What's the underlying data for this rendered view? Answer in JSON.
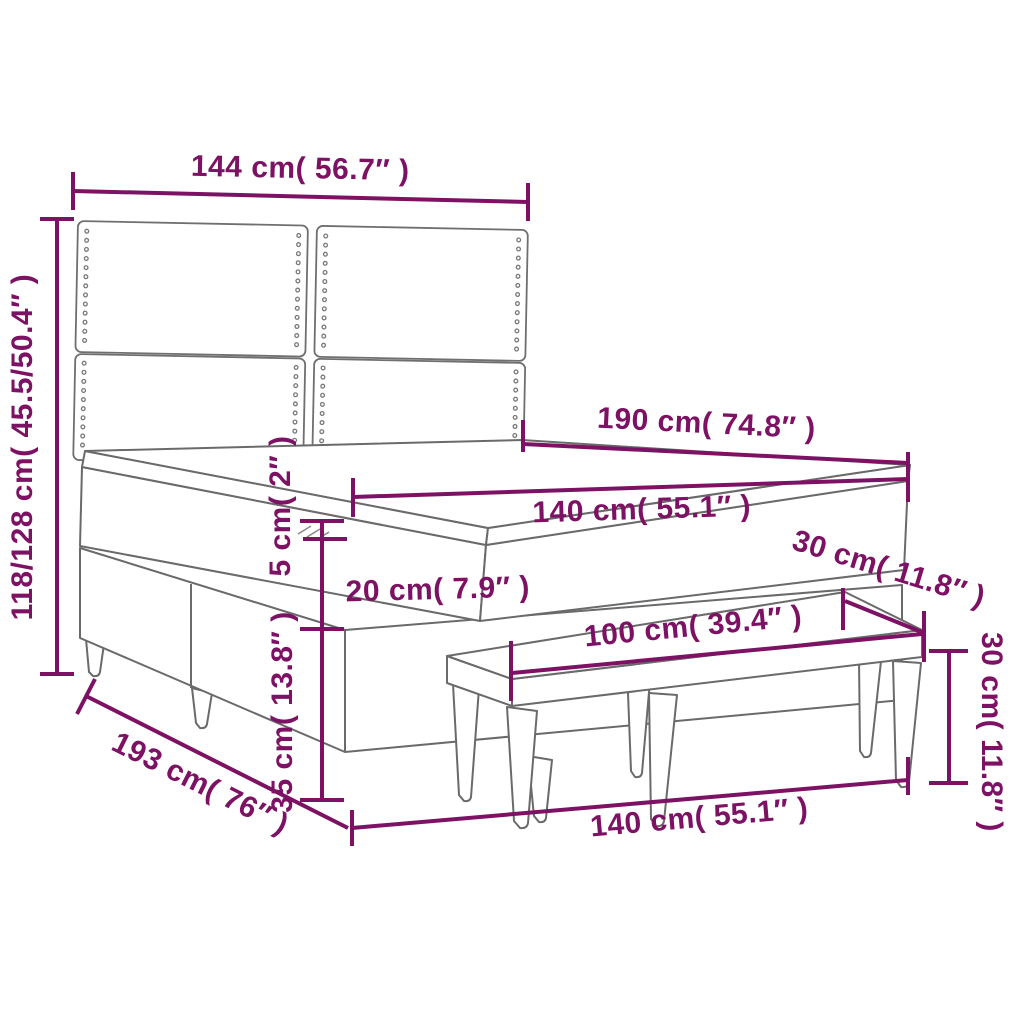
{
  "page": {
    "background": "#ffffff"
  },
  "diagram": {
    "title": "Box spring bed with headboard, topper and bench — dimension diagram",
    "accent_color": "#7d1163",
    "outline_color": "#6a6a6a",
    "dimensions": {
      "headboard_width": "144 cm( 56.7″ )",
      "total_height": "118/128 cm( 45.5/50.4″ )",
      "bed_length": "190 cm( 74.8″ )",
      "mattress_width": "140 cm( 55.1″ )",
      "topper_height": "5 cm( 2″ )",
      "mattress_height": "20 cm( 7.9″ )",
      "bench_depth": "30 cm( 11.8″ )",
      "bench_length": "100 cm( 39.4″ )",
      "bench_height": "30 cm( 11.8″ )",
      "base_height": "35 cm( 13.8″ )",
      "total_length": "193 cm( 76″ )",
      "bed_width": "140 cm( 55.1″ )"
    }
  }
}
